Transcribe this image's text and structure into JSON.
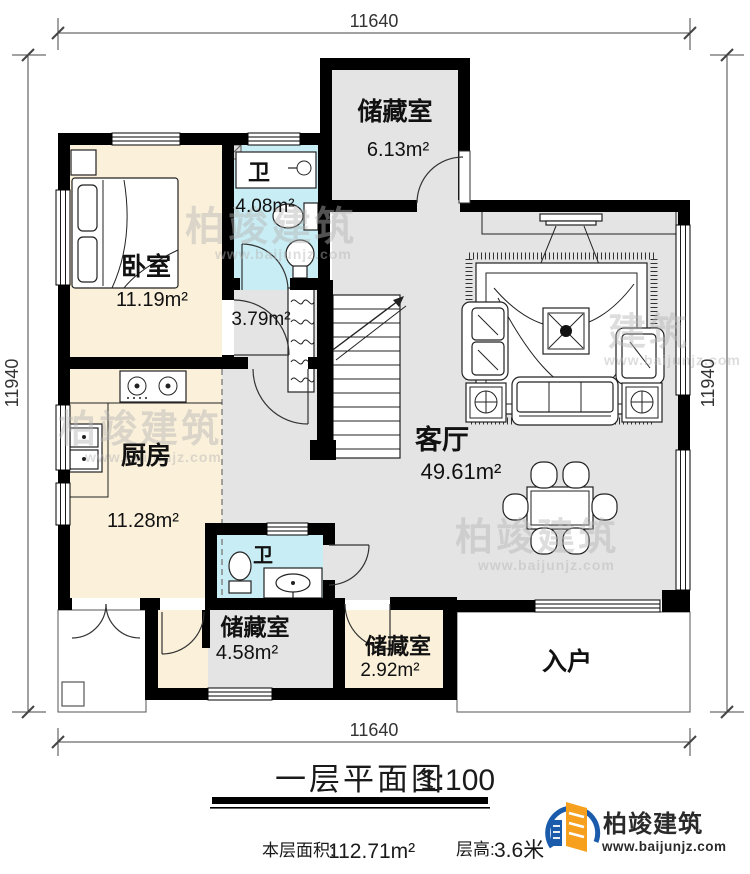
{
  "dimensions": {
    "top": "11640",
    "bottom": "11640",
    "left": "11940",
    "right": "11940"
  },
  "rooms": {
    "storage_top": {
      "name": "储藏室",
      "area": "6.13m²"
    },
    "bath1": {
      "name": "卫",
      "area": "4.08m²"
    },
    "bedroom": {
      "name": "卧室",
      "area": "11.19m²"
    },
    "corridor": {
      "area": "3.79m²"
    },
    "kitchen": {
      "name": "厨房",
      "area": "11.28m²"
    },
    "living": {
      "name": "客厅",
      "area": "49.61m²"
    },
    "bath2": {
      "name": "卫"
    },
    "storage_left": {
      "name": "储藏室",
      "area": "4.58m²"
    },
    "storage_mid": {
      "name": "储藏室",
      "area": "2.92m²"
    },
    "entry": {
      "name": "入户"
    }
  },
  "title": {
    "text": "一层平面图",
    "scale": "1:100"
  },
  "footer": {
    "area_label": "本层面积:",
    "area_value": "112.71m²",
    "height_label": "层高:",
    "height_value": "3.6米"
  },
  "logo": {
    "name": "柏竣建筑",
    "url": "www.baijunjz.com"
  },
  "watermark": {
    "brand": "柏竣建筑",
    "url": "www.baijunjz.com",
    "partial": "建筑"
  },
  "colors": {
    "wall": "#000000",
    "floor_gray": "#e4e4e4",
    "floor_beige": "#fbf1da",
    "floor_bath": "#c9edf4",
    "logo_blue": "#1b5bab",
    "logo_orange": "#f6a01e"
  }
}
